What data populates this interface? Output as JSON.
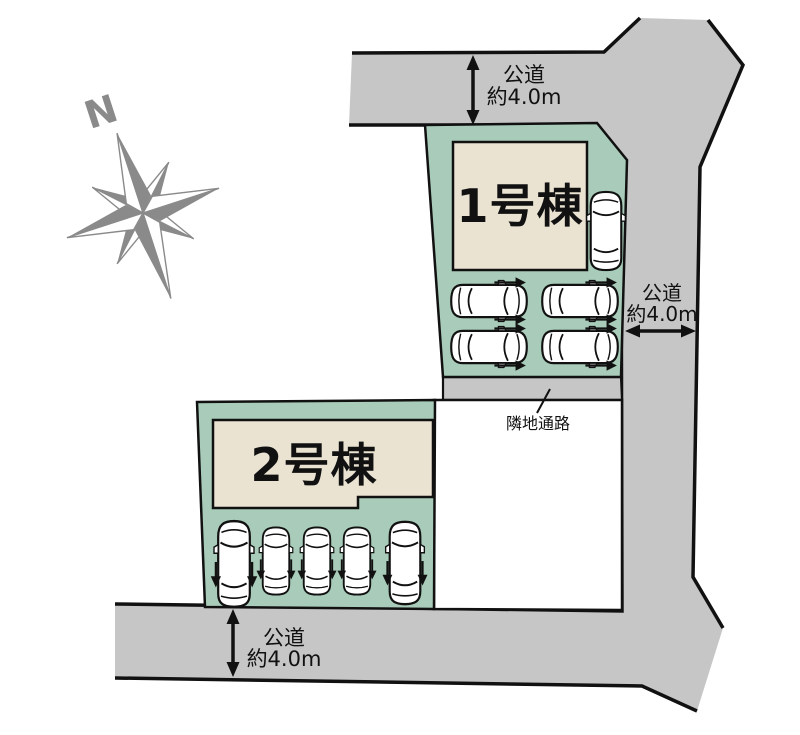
{
  "diagram": {
    "compass_label": "N",
    "buildings": [
      {
        "label": "1号棟"
      },
      {
        "label": "2号棟"
      }
    ],
    "roads": {
      "top": {
        "name": "公道",
        "width": "約4.0m"
      },
      "right": {
        "name": "公道",
        "width": "約4.0m"
      },
      "bottom": {
        "name": "公道",
        "width": "約4.0m"
      }
    },
    "passage_label": "隣地通路",
    "parking": {
      "plot1_car_count": 5,
      "plot2_car_count": 5
    },
    "colors": {
      "plot_green": "#a8ccb9",
      "building_beige": "#eae3d2",
      "road_gray": "#c6c6c6",
      "compass_gray": "#8a8a8a",
      "outline": "#111111"
    }
  }
}
